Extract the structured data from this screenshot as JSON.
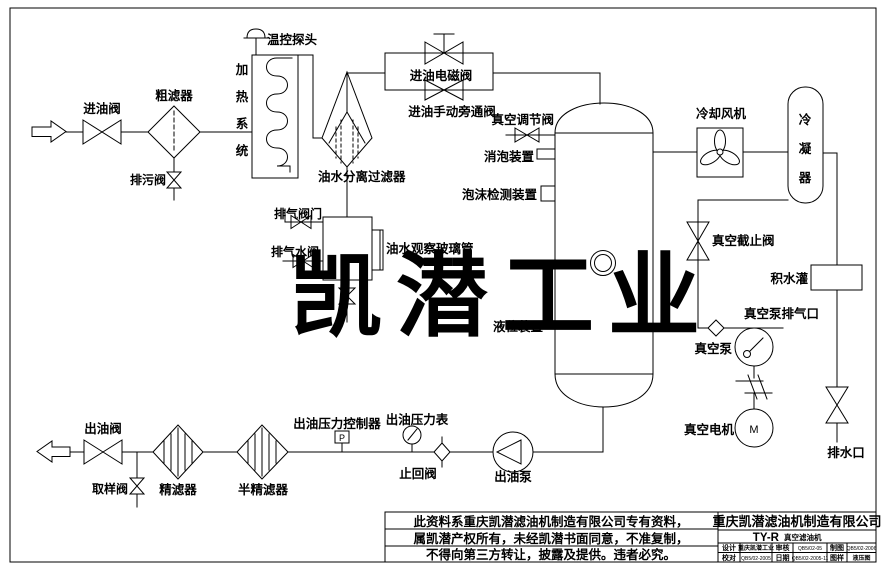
{
  "page": {
    "background": "#ffffff",
    "line_color": "#000000",
    "watermark_color": "#e9e9e9",
    "warning_color": "#33cc33"
  },
  "watermark": {
    "text": "凯潜工业"
  },
  "diagram": {
    "labels": {
      "inlet_valve": "进油阀",
      "coarse_filter": "粗滤器",
      "blowdown_valve": "排污阀",
      "temp_probe": "温控探头",
      "separator_filter": "油水分离过滤器",
      "inlet_solenoid_valve": "进油电磁阀",
      "inlet_manual_bypass_valve": "进油手动旁通阀",
      "vacuum_regulating_valve": "真空调节阀",
      "defoaming_device": "消泡装置",
      "foam_detection_device": "泡沫检测装置",
      "exhaust_valve": "排气阀门",
      "exhaust_water_valve": "排气水阀",
      "oil_water_sight_glass": "油水观察玻璃管",
      "liquid_level_device": "液位装置",
      "cooling_fan": "冷却风机",
      "vacuum_stop_valve": "真空截止阀",
      "water_collection_tank": "积水灌",
      "vacuum_pump_exhaust_port": "真空泵排气口",
      "vacuum_pump": "真空泵",
      "vacuum_motor": "真空电机",
      "motor_symbol": "M",
      "drain_outlet": "排水口",
      "outlet_valve": "出油阀",
      "sampling_valve": "取样阀",
      "fine_filter": "精滤器",
      "semi_fine_filter": "半精滤器",
      "outlet_pressure_controller": "出油压力控制器",
      "pressure_symbol": "P",
      "outlet_pressure_gauge": "出油压力表",
      "check_valve": "止回阀",
      "outlet_pump": "出油泵"
    },
    "vertical_labels": {
      "heating_system": [
        "加",
        "热",
        "系",
        "统"
      ],
      "condenser": [
        "冷",
        "凝",
        "器"
      ]
    }
  },
  "warning_box": {
    "lines": [
      "此资料系重庆凯潜滤油机制造有限公司专有资料，",
      "属凯潜产权所有，未经凯潜书面同意，不准复制，",
      "不得向第三方转让，披露及提供。违者必究。"
    ]
  },
  "title_block": {
    "company": "重庆凯潜滤油机制造有限公司",
    "model": "TY-R",
    "model_name": "真空滤油机",
    "cells": {
      "r1c1": "设计",
      "r1c2": "重庆凯潜工业",
      "r1c3": "审核",
      "r1c4": "QB5/02-05",
      "r1c5": "制图",
      "r1c6": "QB5/02-2006",
      "r2c1": "校对",
      "r2c2": "QB5/02-2005",
      "r2c3": "日期",
      "r2c4": "QB5/02-2005-11",
      "r2c5": "图样",
      "r2c6": "液压图"
    }
  }
}
